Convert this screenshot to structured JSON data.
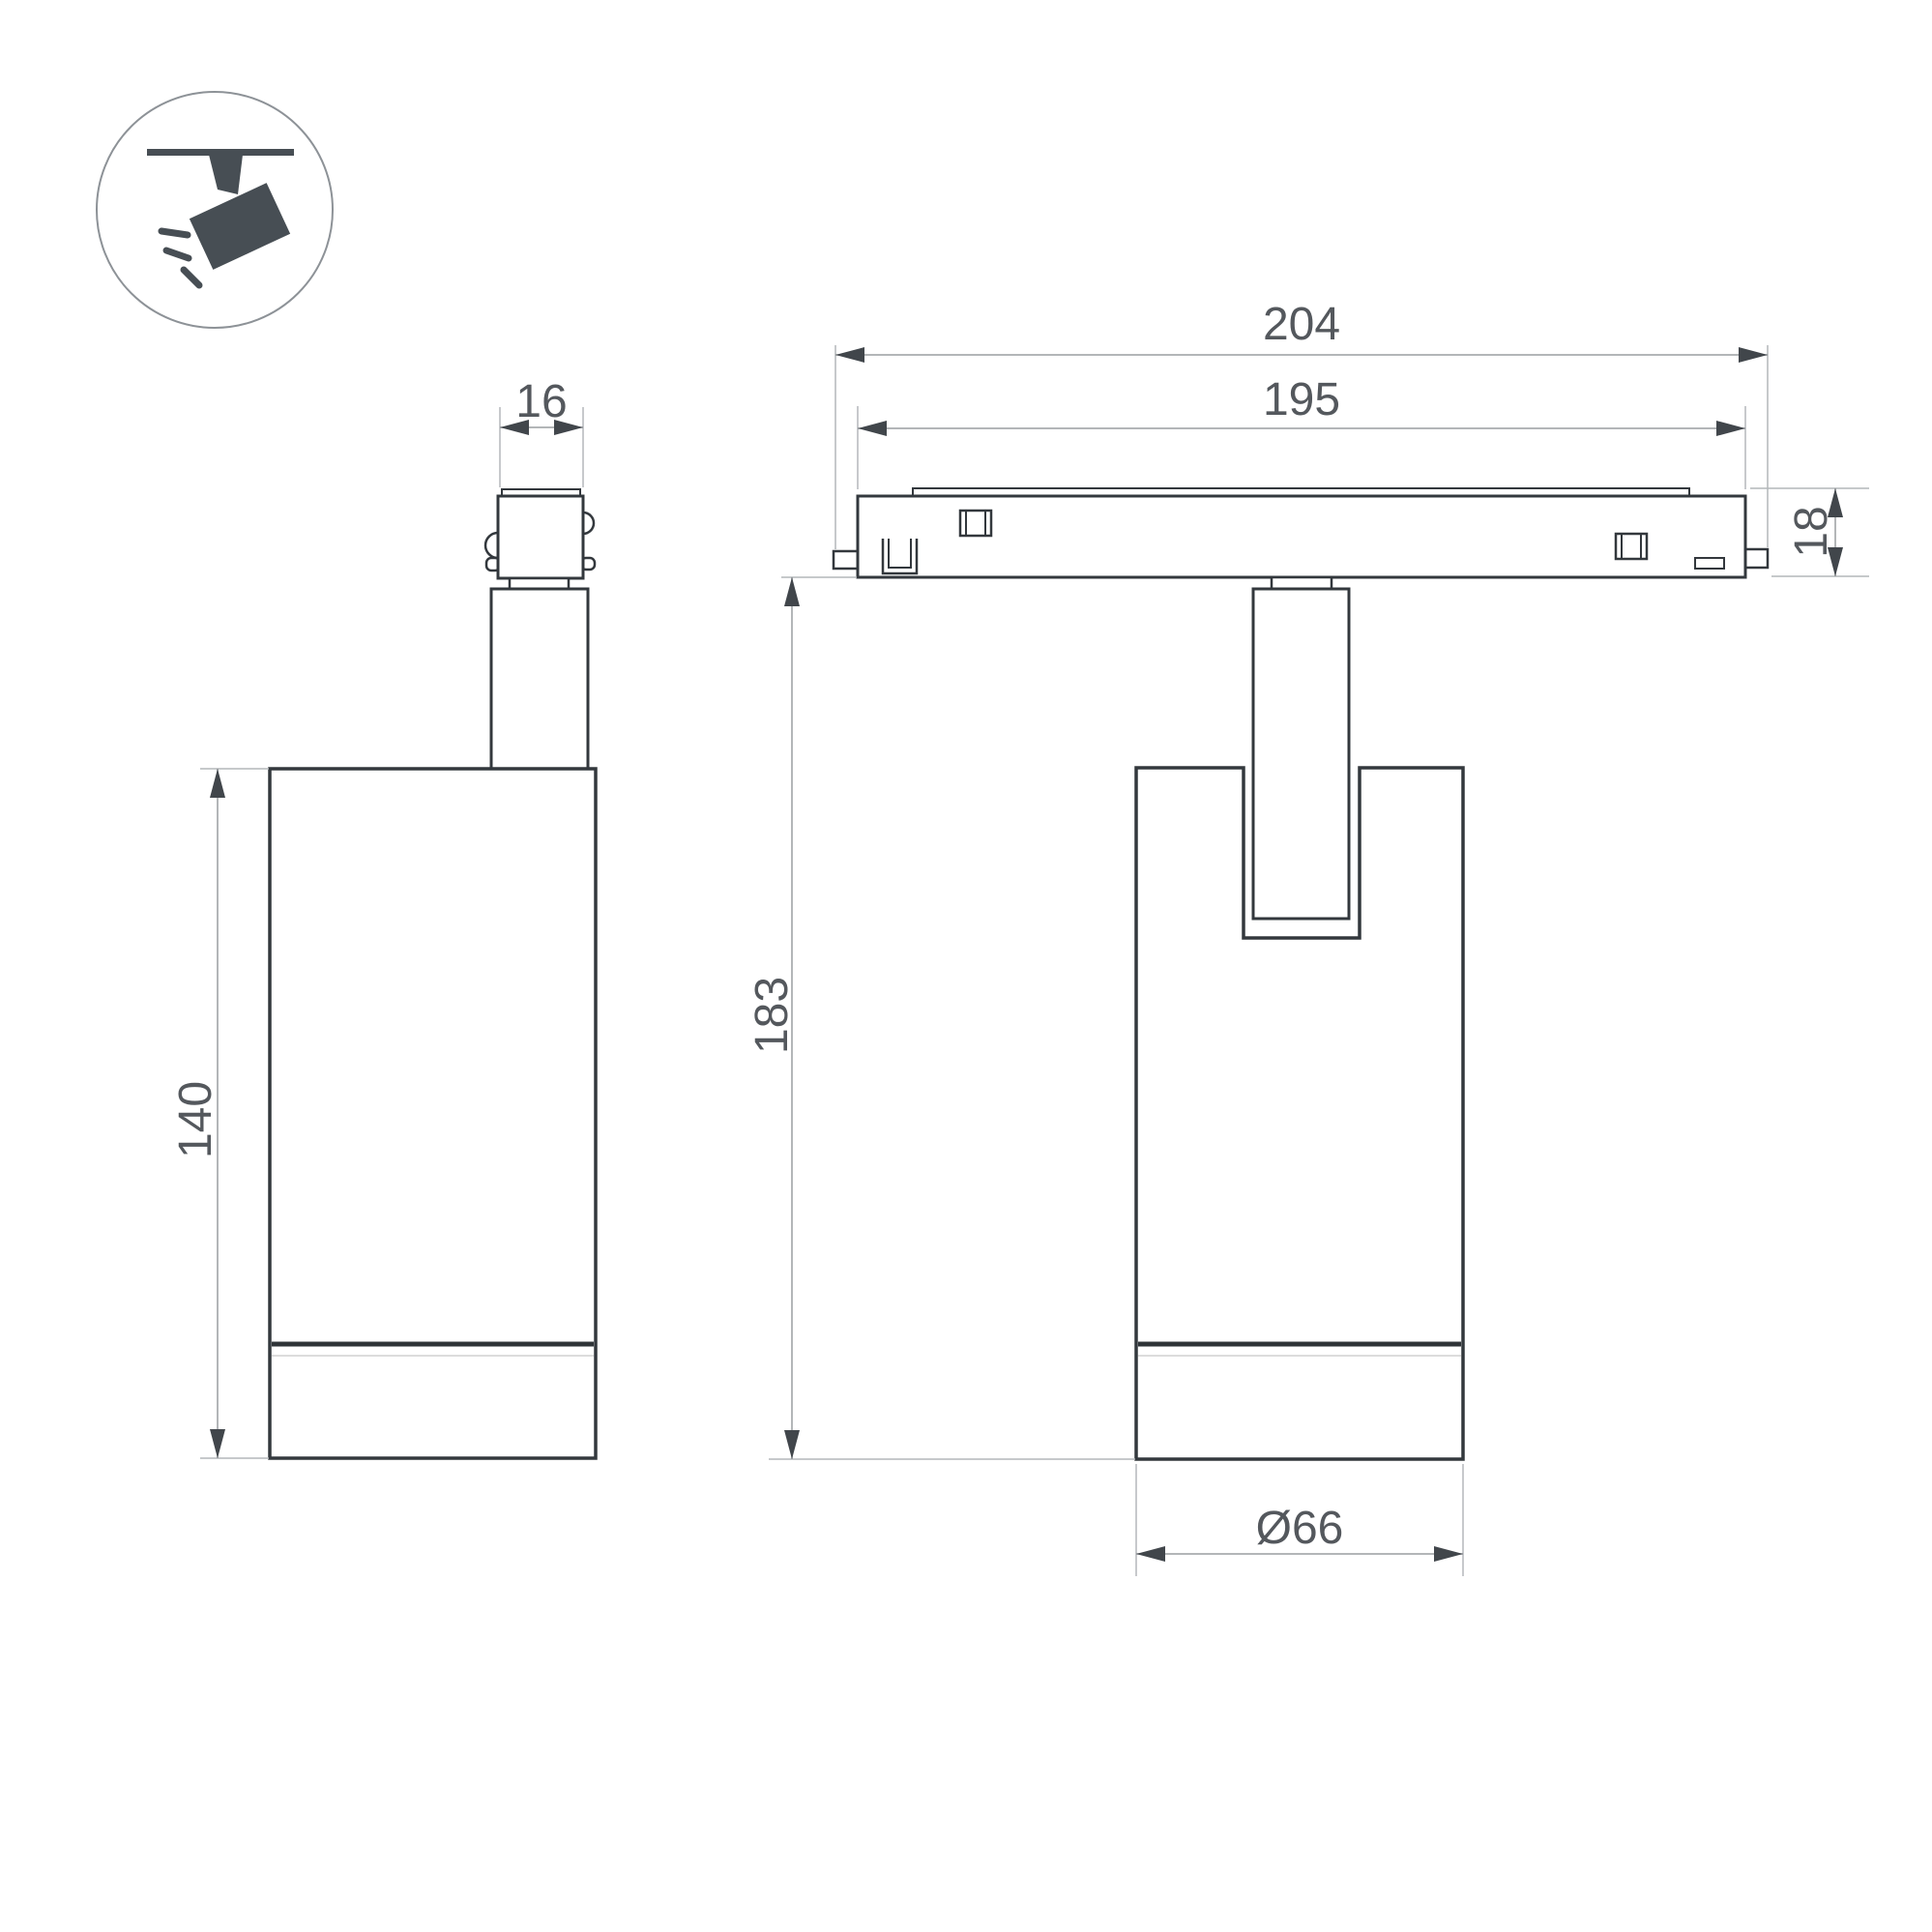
{
  "drawing": {
    "title": "Ceiling track spotlight — dimension drawing",
    "units": "mm",
    "dimensions": {
      "adapter_width": {
        "label": "16"
      },
      "body_height": {
        "label": "140"
      },
      "track_length_overall": {
        "label": "204"
      },
      "track_length_inner": {
        "label": "195"
      },
      "track_height": {
        "label": "18"
      },
      "fixture_height": {
        "label": "183"
      },
      "body_diameter": {
        "label": "Ø66"
      }
    },
    "colors": {
      "background": "#ffffff",
      "outline": "#33383d",
      "trim_line": "#2f3438",
      "faint_line": "#dcdcdc",
      "dimension_line": "#9a9da1",
      "extension_line": "#b4b7ba",
      "arrow": "#41464b",
      "text": "#54585d",
      "icon_fill": "#474e54",
      "icon_circle_stroke": "#8d9297"
    }
  }
}
